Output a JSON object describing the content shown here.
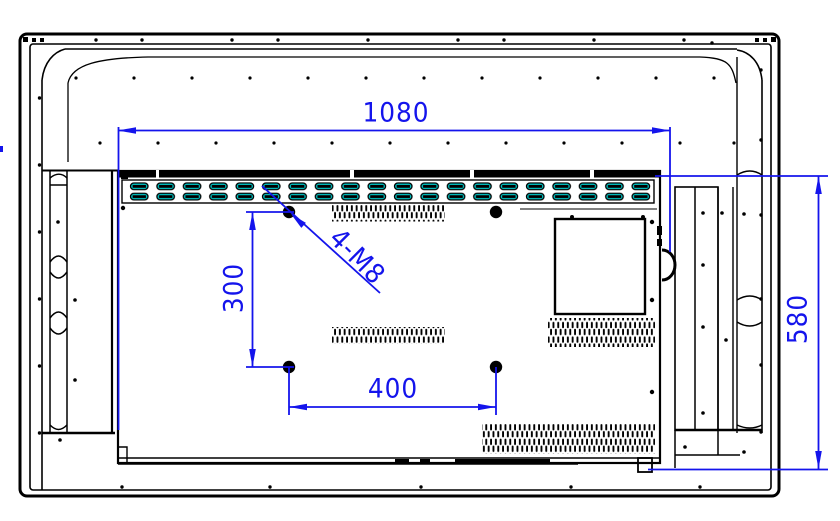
{
  "drawing": {
    "type": "technical-drawing",
    "subject": "Display rear view with VESA wall-mount dimensions",
    "labels": {
      "overall_width": "1080",
      "overall_height": "580",
      "vesa_vertical": "300",
      "vesa_horizontal": "400",
      "mount_thread": "4-M8"
    },
    "colors": {
      "dimension_blue": "#1414ec",
      "vent_cyan": "#00c8c8",
      "line_black": "#000000",
      "background": "#ffffff"
    }
  }
}
